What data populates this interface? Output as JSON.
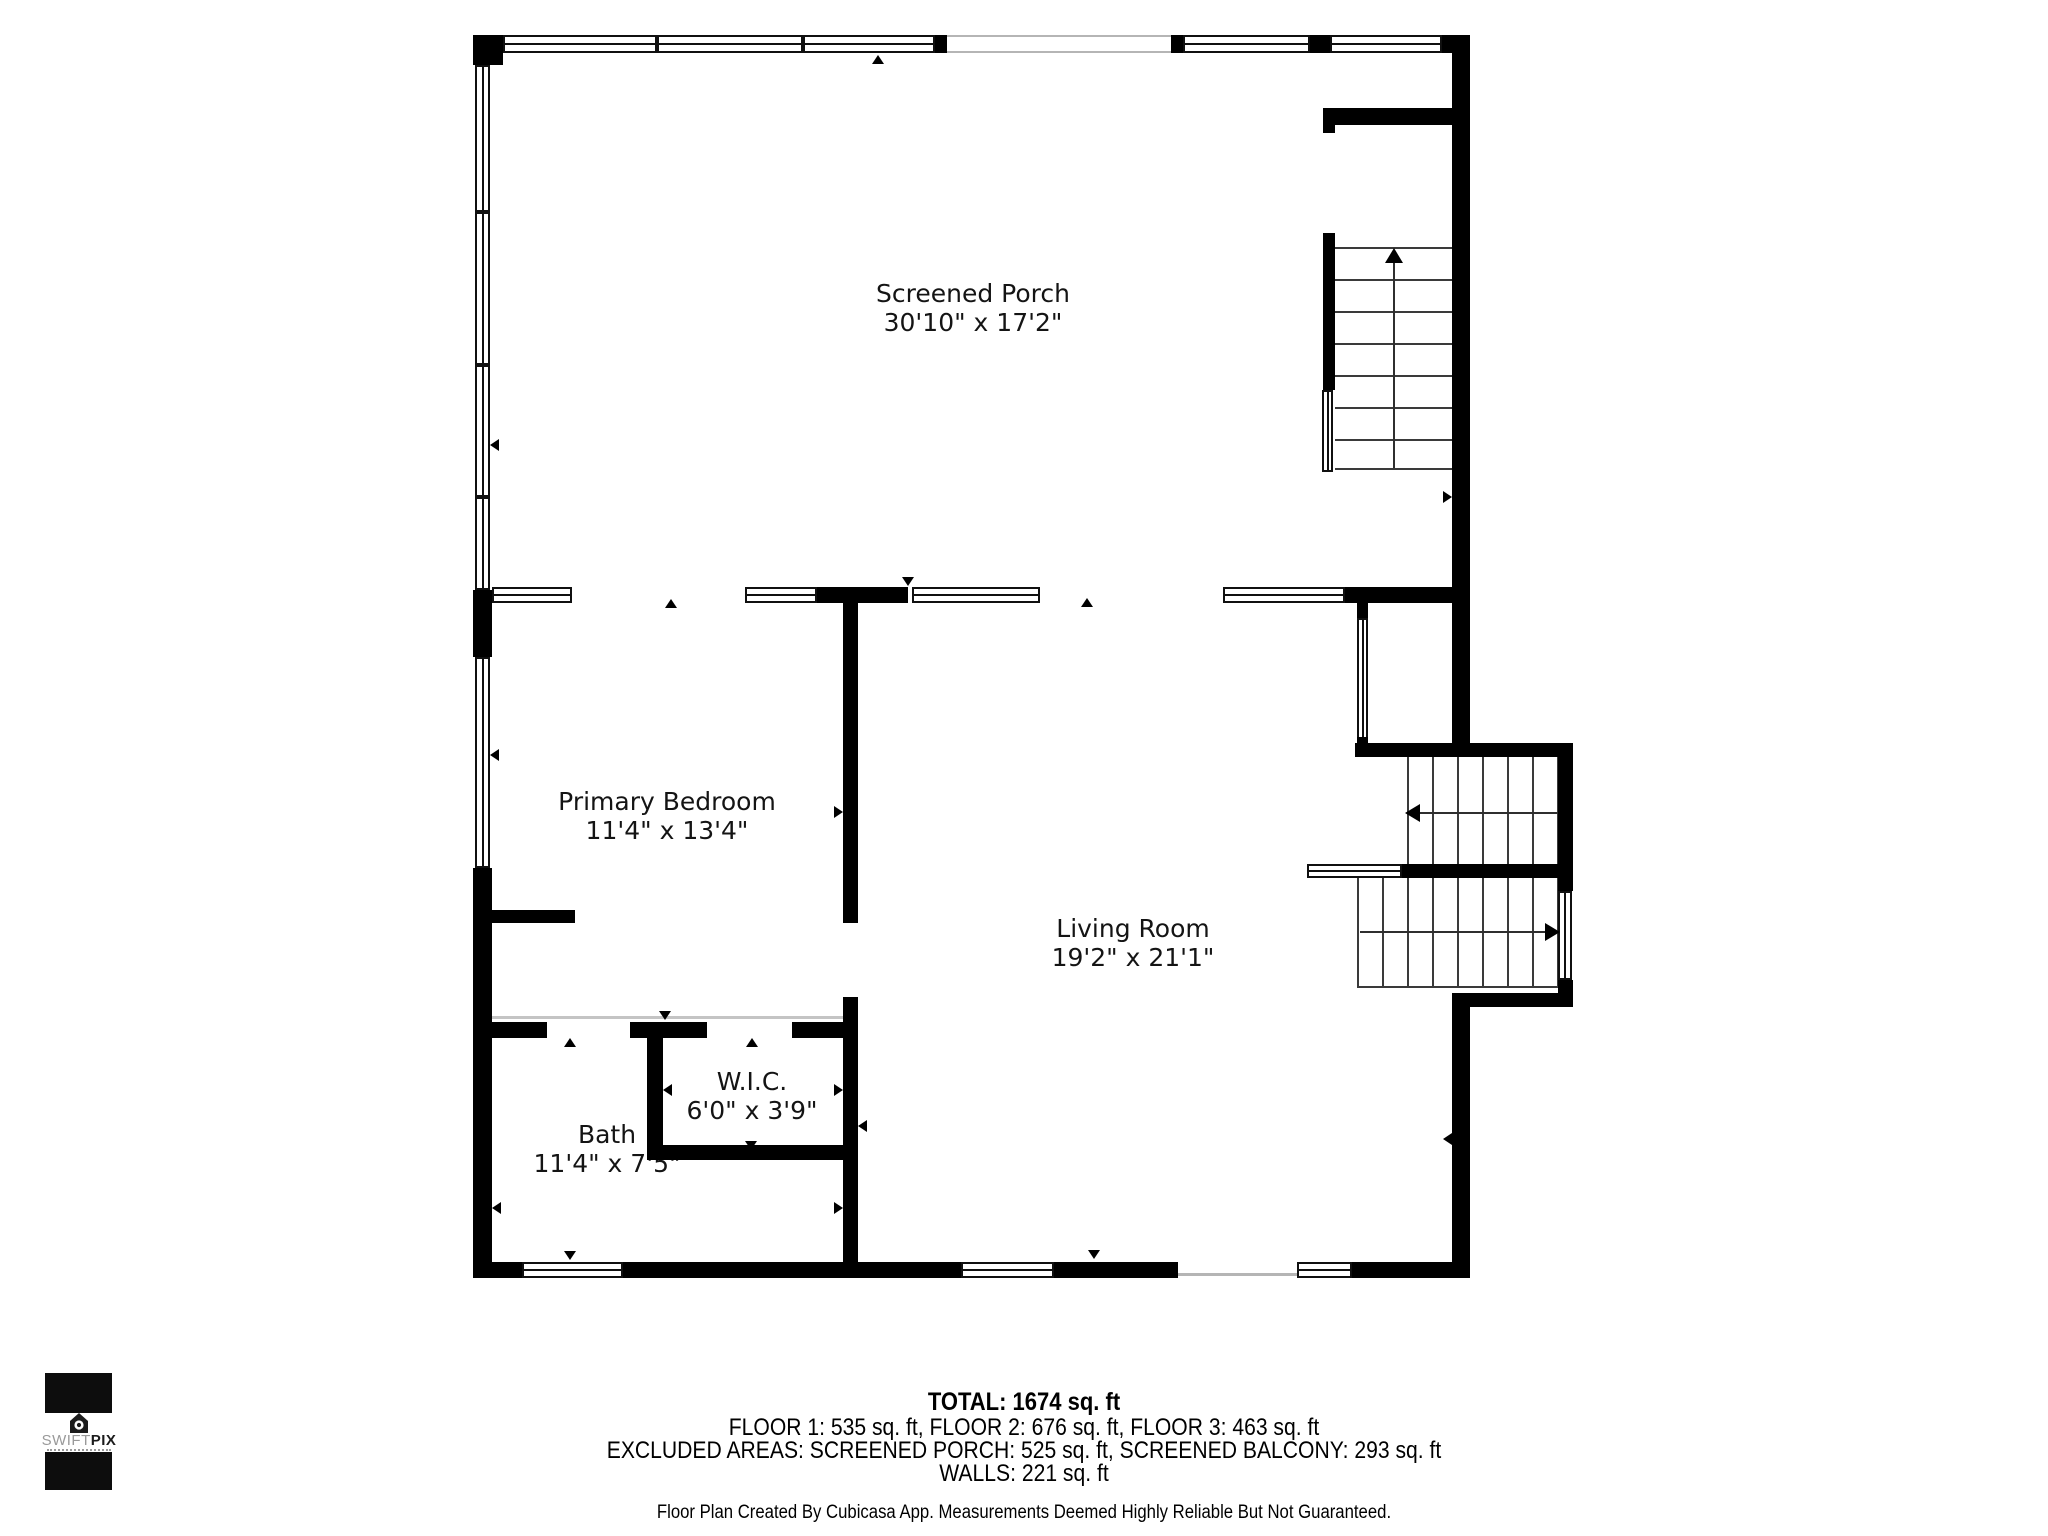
{
  "rooms": {
    "screened_porch": {
      "name": "Screened Porch",
      "dims": "30'10\" x 17'2\""
    },
    "primary_bedroom": {
      "name": "Primary Bedroom",
      "dims": "11'4\" x 13'4\""
    },
    "living_room": {
      "name": "Living Room",
      "dims": "19'2\" x 21'1\""
    },
    "wic": {
      "name": "W.I.C.",
      "dims": "6'0\" x 3'9\""
    },
    "bath": {
      "name": "Bath",
      "dims": "11'4\" x 7'5\""
    }
  },
  "summary": {
    "total": "TOTAL: 1674 sq. ft",
    "floors": "FLOOR 1: 535 sq. ft, FLOOR 2: 676 sq. ft, FLOOR 3: 463 sq. ft",
    "excluded": "EXCLUDED AREAS: SCREENED PORCH: 525 sq. ft, SCREENED BALCONY: 293 sq. ft",
    "walls": "WALLS: 221 sq. ft",
    "disclaimer": "Floor Plan Created By Cubicasa App. Measurements Deemed Highly Reliable But Not Guaranteed."
  },
  "logo": {
    "brand_light": "SWIFT",
    "brand_bold": "PIX"
  },
  "colors": {
    "wall": "#000000",
    "open_boundary": "#b5b5b5",
    "background": "#ffffff"
  }
}
